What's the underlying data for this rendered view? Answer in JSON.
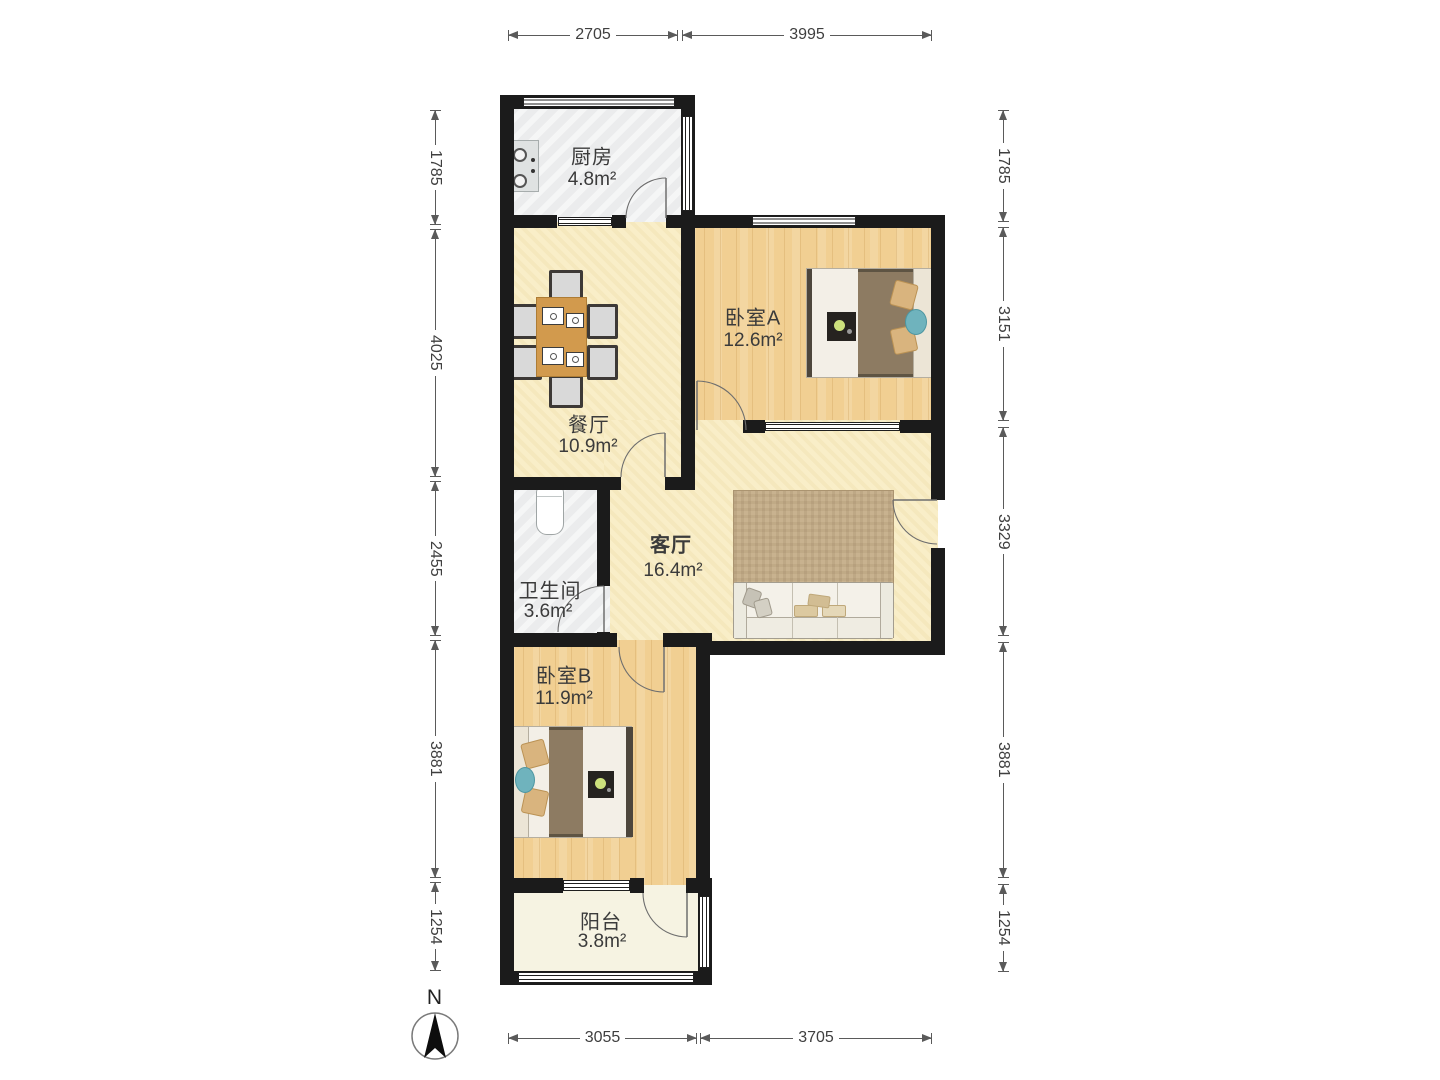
{
  "plan": {
    "rooms": {
      "kitchen": {
        "name": "厨房",
        "area": "4.8m²"
      },
      "bedroom_a": {
        "name": "卧室A",
        "area": "12.6m²"
      },
      "dining": {
        "name": "餐厅",
        "area": "10.9m²"
      },
      "living": {
        "name": "客厅",
        "area": "16.4m²"
      },
      "bathroom": {
        "name": "卫生间",
        "area": "3.6m²"
      },
      "bedroom_b": {
        "name": "卧室B",
        "area": "11.9m²"
      },
      "balcony": {
        "name": "阳台",
        "area": "3.8m²"
      }
    },
    "dimensions": {
      "top": [
        "2705",
        "3995"
      ],
      "bottom": [
        "3055",
        "3705"
      ],
      "left": [
        "1785",
        "4025",
        "2455",
        "3881",
        "1254"
      ],
      "right": [
        "1785",
        "3151",
        "3329",
        "3881",
        "1254"
      ]
    },
    "compass": {
      "label": "N"
    },
    "colors": {
      "wall": "#1b1b1b",
      "wood_floor": "#f1cf92",
      "beige_floor": "#f9eec8",
      "tile_floor": "#ebeced",
      "balcony_floor": "#f6f3e2",
      "rug": "#c8b28f",
      "duvet": "#8d7b62",
      "pillow": "#d9b47e",
      "teal_cushion": "#6fb3bd",
      "table": "#d29a4d"
    }
  }
}
